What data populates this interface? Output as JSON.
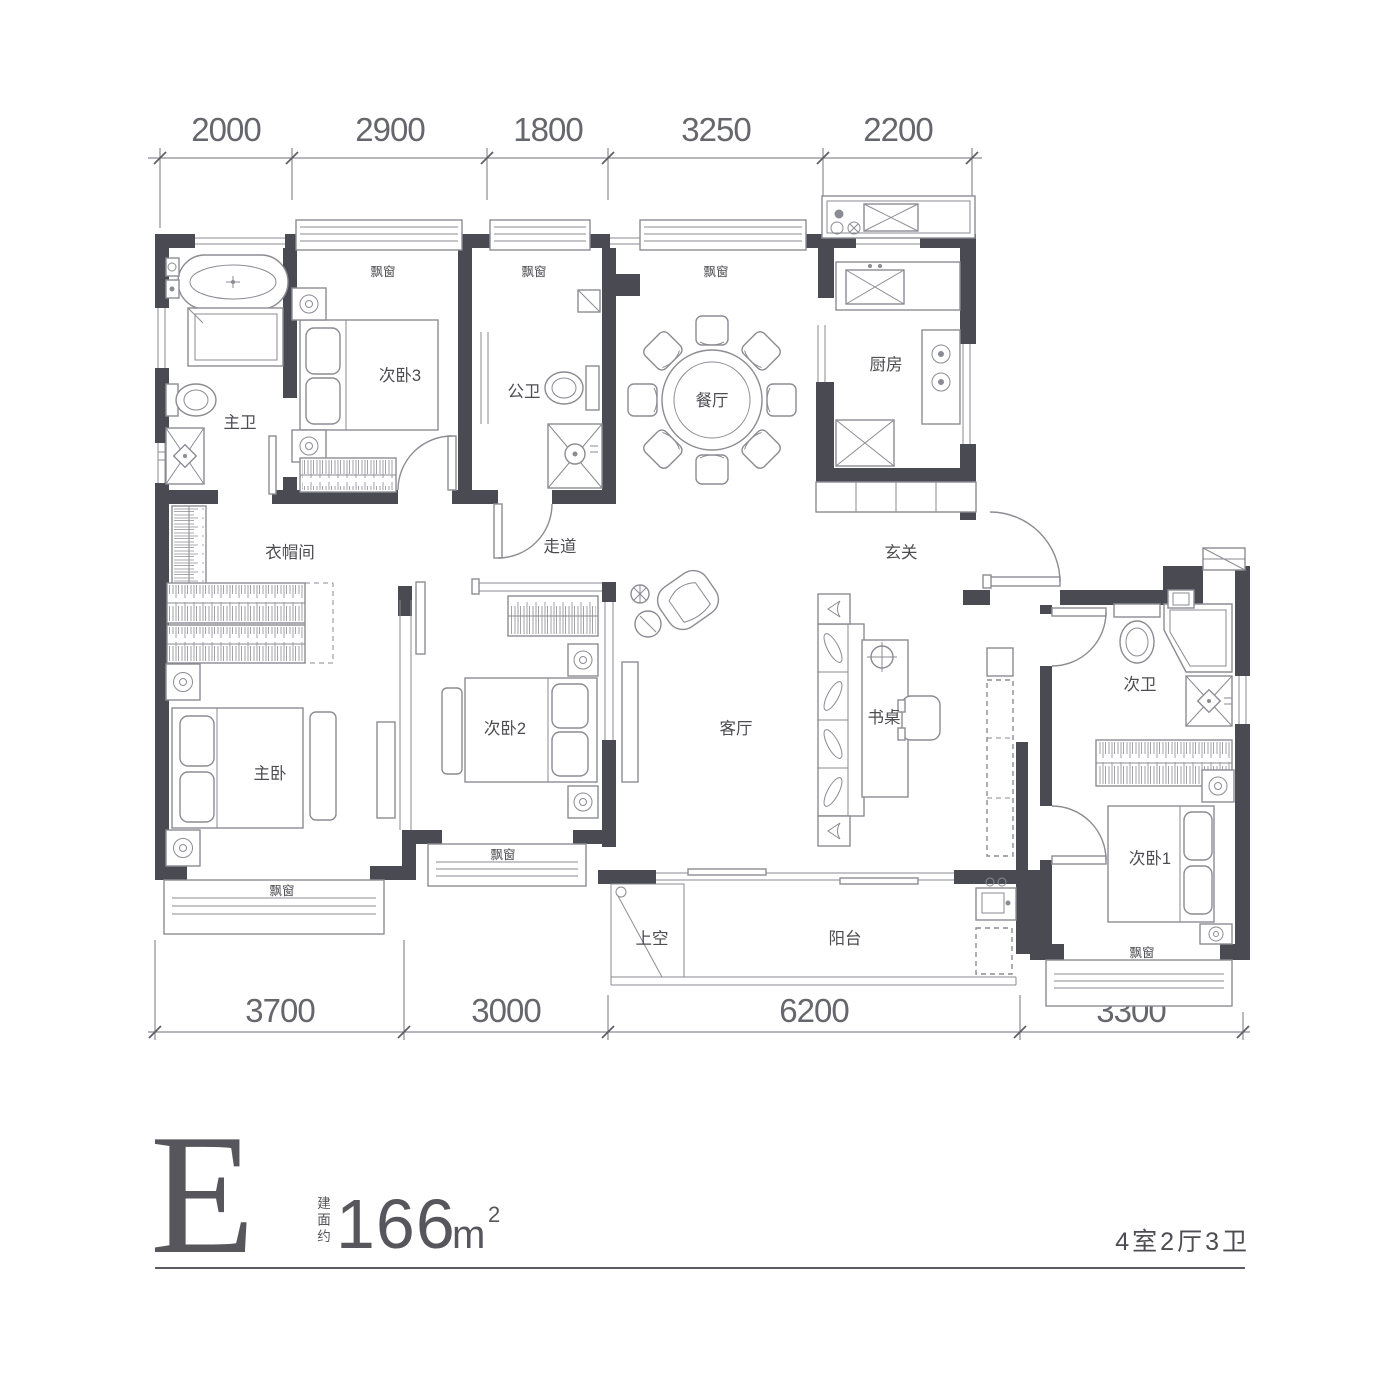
{
  "colors": {
    "wall": "#4a4a52",
    "line": "#8b8b93",
    "text": "#4c4c52",
    "dim_text": "#66666d",
    "title": "#56565c"
  },
  "dimensions": {
    "top": [
      "2000",
      "2900",
      "1800",
      "3250",
      "2200"
    ],
    "bottom": [
      "3700",
      "3000",
      "6200",
      "3300"
    ]
  },
  "rooms": {
    "master_bath": "主卫",
    "bedroom3": "次卧3",
    "public_bath": "公卫",
    "dining": "餐厅",
    "kitchen": "厨房",
    "cloakroom": "衣帽间",
    "corridor": "走道",
    "foyer": "玄关",
    "master_bedroom": "主卧",
    "bedroom2": "次卧2",
    "living": "客厅",
    "desk": "书桌",
    "second_bath": "次卫",
    "bedroom1": "次卧1",
    "void": "上空",
    "balcony": "阳台",
    "bay_window": "飘窗"
  },
  "title": {
    "plan_letter": "E",
    "area_prefix": "建面约",
    "area_value": "166",
    "area_unit": "m",
    "area_sup": "2",
    "layout_spec": "4室2厅3卫"
  }
}
